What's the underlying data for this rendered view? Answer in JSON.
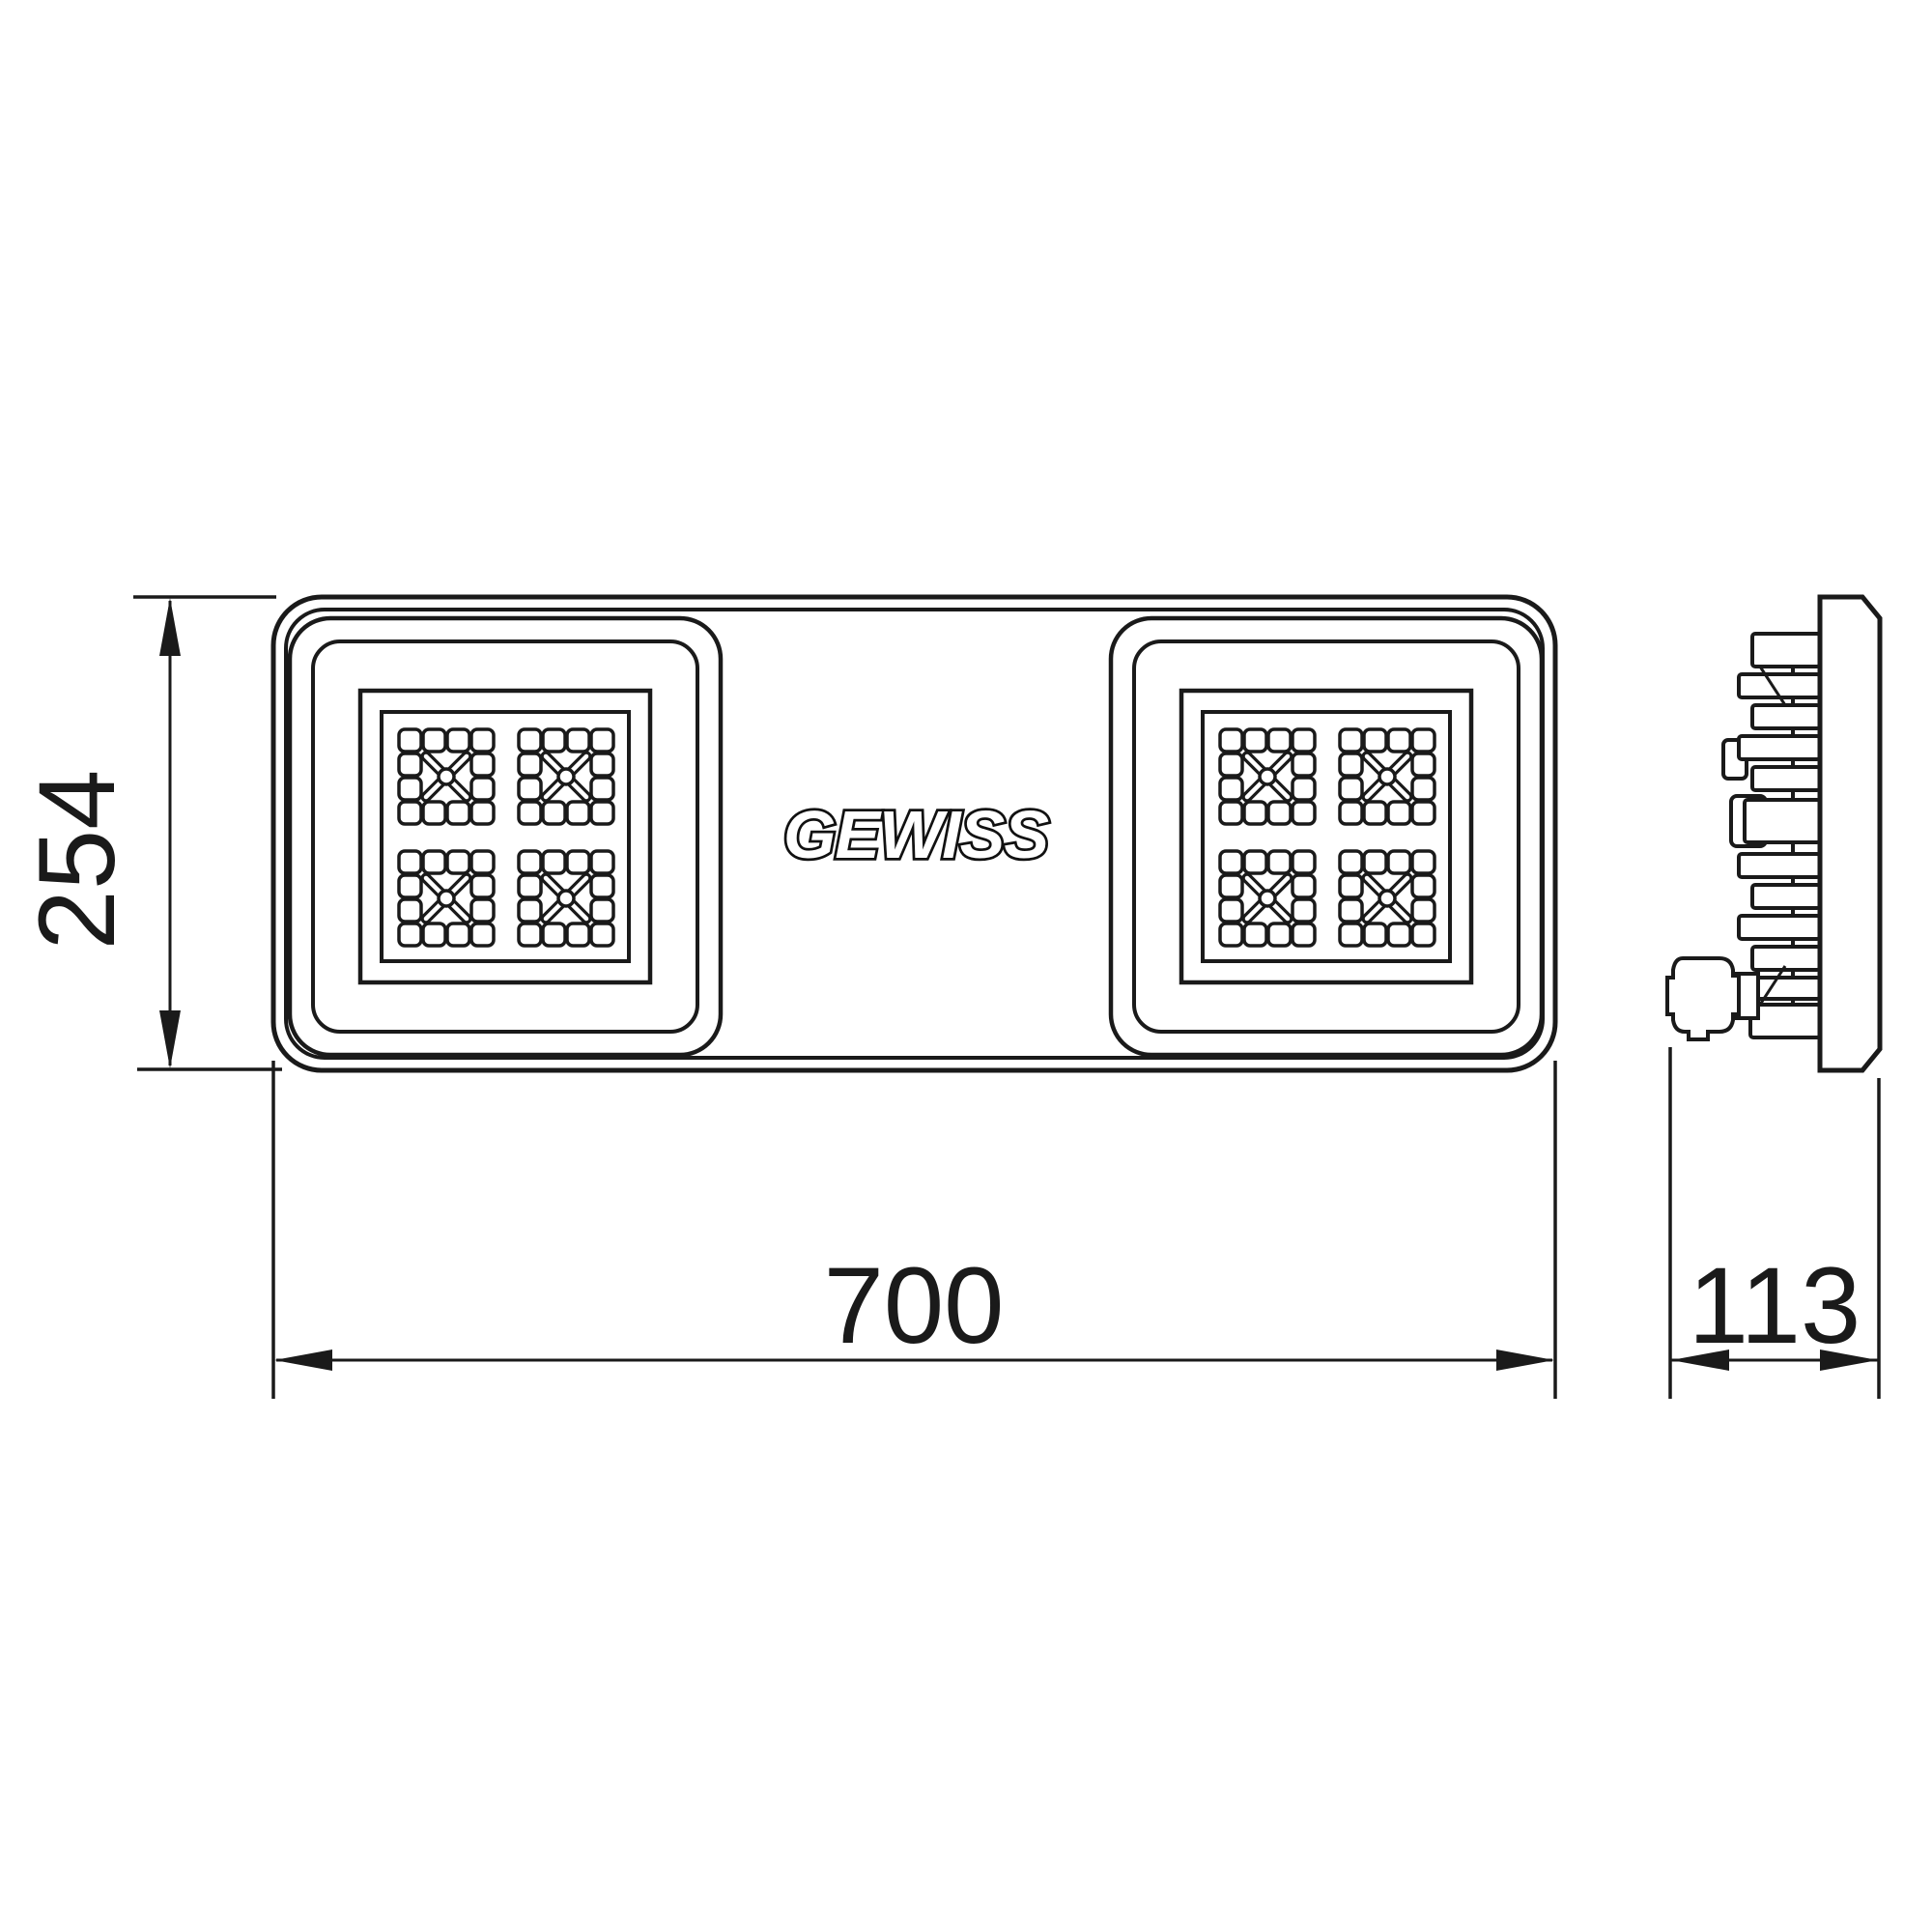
{
  "drawing": {
    "brand": "GEWISS",
    "views": {
      "front": "floodlight front view with two LED modules",
      "side": "floodlight side profile with heatsink fins and cable gland"
    },
    "dimensions": {
      "height": "254",
      "width": "700",
      "depth": "113"
    },
    "colors": {
      "line": "#1a1a1a",
      "background": "#ffffff"
    }
  }
}
